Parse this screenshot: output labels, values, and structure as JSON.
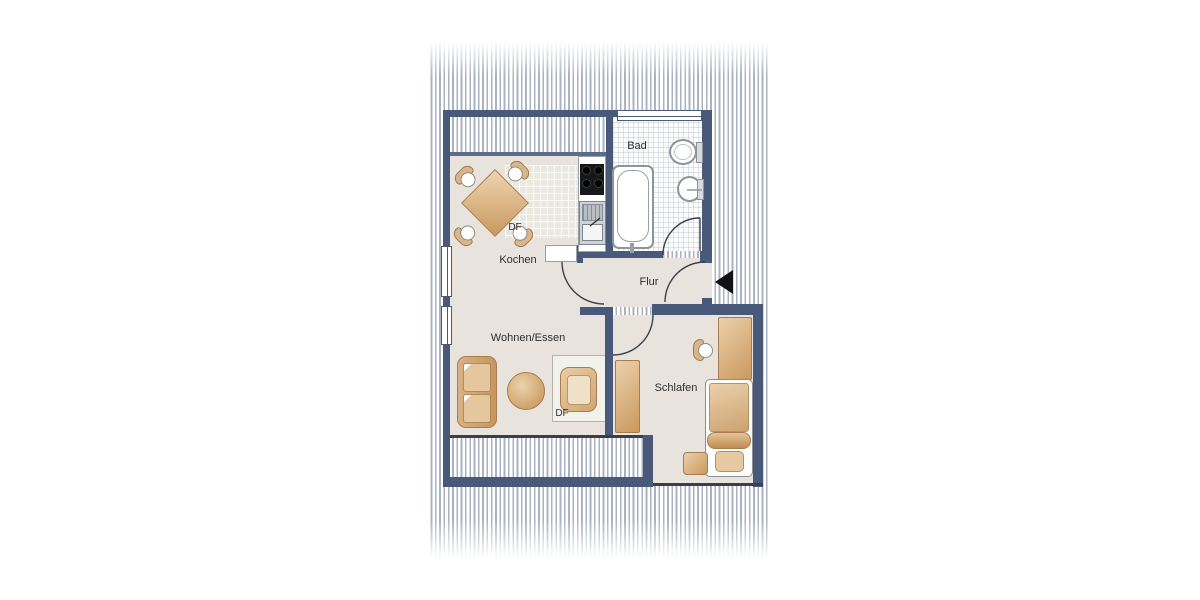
{
  "rooms": {
    "bad": {
      "label": "Bad"
    },
    "kochen": {
      "label": "Kochen"
    },
    "flur": {
      "label": "Flur"
    },
    "wohnen": {
      "label": "Wohnen/Essen"
    },
    "schlafen": {
      "label": "Schlafen"
    }
  },
  "skylights": {
    "kitchen_df": "DF",
    "living_df": "DF"
  },
  "icons": {
    "entrance_arrow": "left-pointing entrance marker"
  },
  "colors": {
    "wall": "#48597a",
    "floor": "#e8e4dd",
    "tile": "#fcfcfc",
    "hatch": "#8e99ac",
    "tan1": "#ecd0aa",
    "tan2": "#c9995f",
    "tan-border": "#a87c4e",
    "line": "#3a4049",
    "text": "#2e2e2e",
    "arrow": "#111111",
    "knee": "#5c6c88"
  }
}
